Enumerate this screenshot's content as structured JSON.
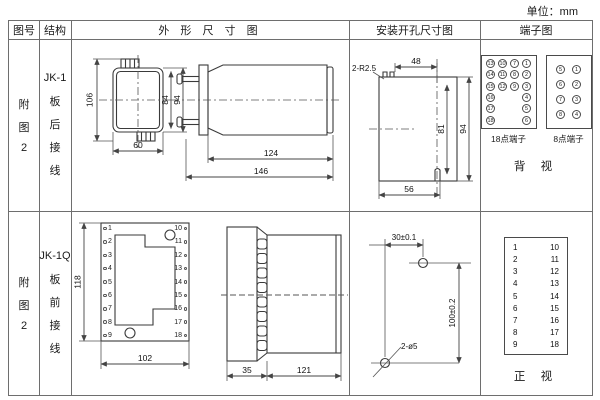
{
  "unit_label": "单位：mm",
  "headers": {
    "fig_no": "图号",
    "structure": "结构",
    "outline": "外 形 尺 寸 图",
    "mounting": "安装开孔尺寸图",
    "terminal": "端子图"
  },
  "row1": {
    "fig_chars": [
      "附",
      "图",
      "2"
    ],
    "model": "JK-1",
    "wiring_chars": [
      "板",
      "后",
      "接",
      "线"
    ],
    "front": {
      "dim_height": "106",
      "dim_inner_height": "84",
      "dim_outer_height": "94",
      "dim_width": "60"
    },
    "side": {
      "dim_body": "124",
      "dim_total": "146"
    },
    "mounting": {
      "corner_note": "2-R2.5",
      "dim_top": "48",
      "dim_inner": "81",
      "dim_outer": "94",
      "dim_bottom": "56"
    },
    "terminals": {
      "t18_cells": [
        "13",
        "10",
        "7",
        "1",
        "14",
        "11",
        "8",
        "2",
        "15",
        "12",
        "9",
        "3",
        "16",
        "",
        "",
        "4",
        "17",
        "",
        "",
        "5",
        "18",
        "",
        "",
        "6"
      ],
      "t18_label": "18点端子",
      "t8_cells": [
        "5",
        "1",
        "6",
        "2",
        "7",
        "3",
        "8",
        "4"
      ],
      "t8_label": "8点端子",
      "view_label": "背 视"
    }
  },
  "row2": {
    "fig_chars": [
      "附",
      "图",
      "2"
    ],
    "model": "JK-1Q",
    "wiring_chars": [
      "板",
      "前",
      "接",
      "线"
    ],
    "front": {
      "dim_height": "118",
      "dim_width": "102",
      "left_terminals": [
        "1",
        "2",
        "3",
        "4",
        "5",
        "6",
        "7",
        "8",
        "9"
      ],
      "right_terminals": [
        "10",
        "11",
        "12",
        "13",
        "14",
        "15",
        "16",
        "17",
        "18"
      ]
    },
    "side": {
      "dim_flange": "35",
      "dim_body": "121"
    },
    "mounting": {
      "dim_h": "30±0.1",
      "dim_v": "100±0.2",
      "hole_note": "2-ø5"
    },
    "terminals": {
      "left": [
        "1",
        "2",
        "3",
        "4",
        "5",
        "6",
        "7",
        "8",
        "9"
      ],
      "right": [
        "10",
        "11",
        "12",
        "13",
        "14",
        "15",
        "16",
        "17",
        "18"
      ],
      "view_label": "正 视"
    }
  },
  "colors": {
    "table_line": "#6e6e6e",
    "drawing_line": "#3a3a3a",
    "text": "#1a1a1a"
  }
}
